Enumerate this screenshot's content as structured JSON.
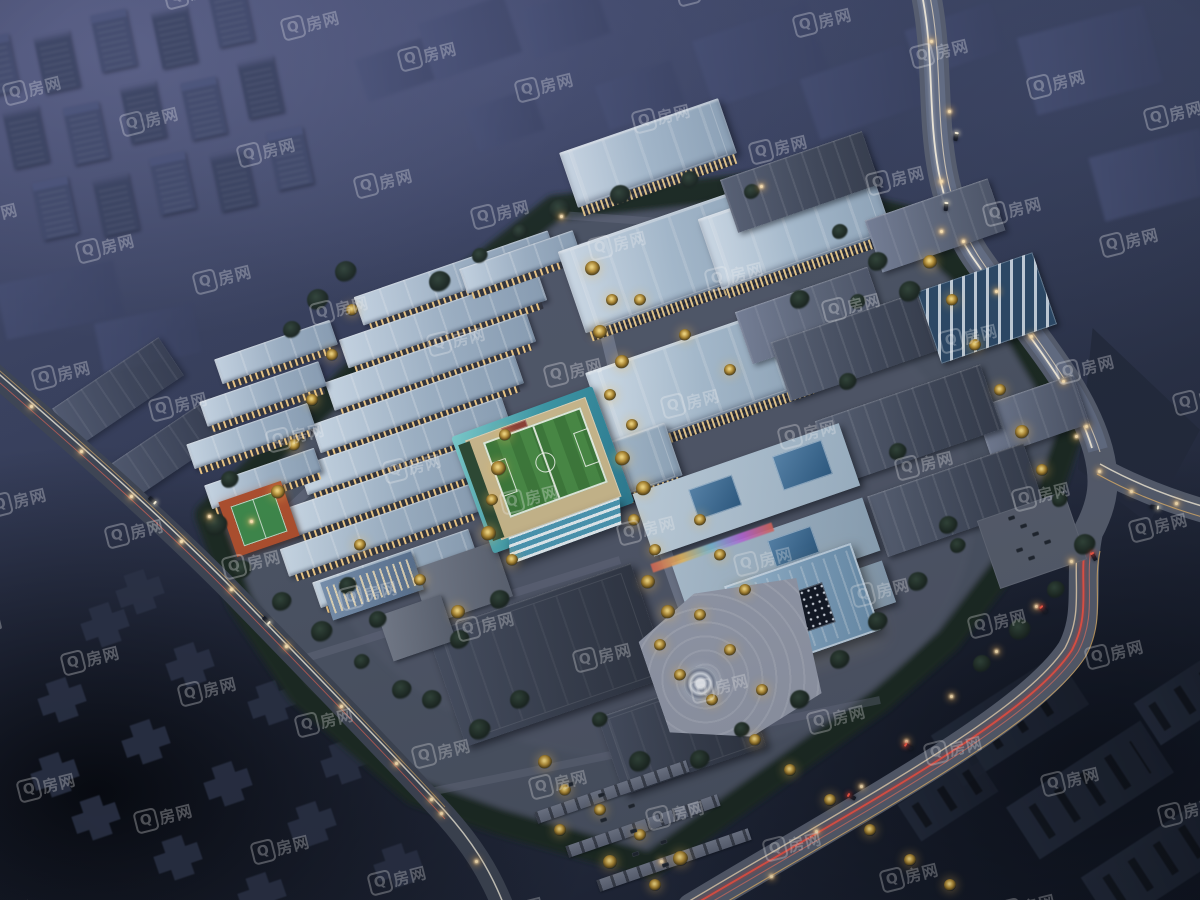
{
  "watermark": {
    "brand_logo_char": "Q",
    "brand_text": "房网",
    "full_text": "Q房网",
    "color": "#ffffff",
    "opacity": 0.3
  },
  "scene": {
    "palette": {
      "sky_haze": "#454b6e",
      "deep_shadow": "#0b0f16",
      "roof_light": "#b6c9da",
      "roof_dark": "#49515f",
      "window_glow": "#ffd892",
      "tree_lit": "#e8c76a",
      "tree_dark": "#1b2620",
      "field_green": "#3e7b3a",
      "field_deck": "#cdbb8e",
      "court_orange": "#b1502e",
      "road_gray": "#596070",
      "trail_white": "#fdf6e3",
      "trail_red": "#ff5646",
      "trail_yellow": "#ffc66e"
    }
  }
}
